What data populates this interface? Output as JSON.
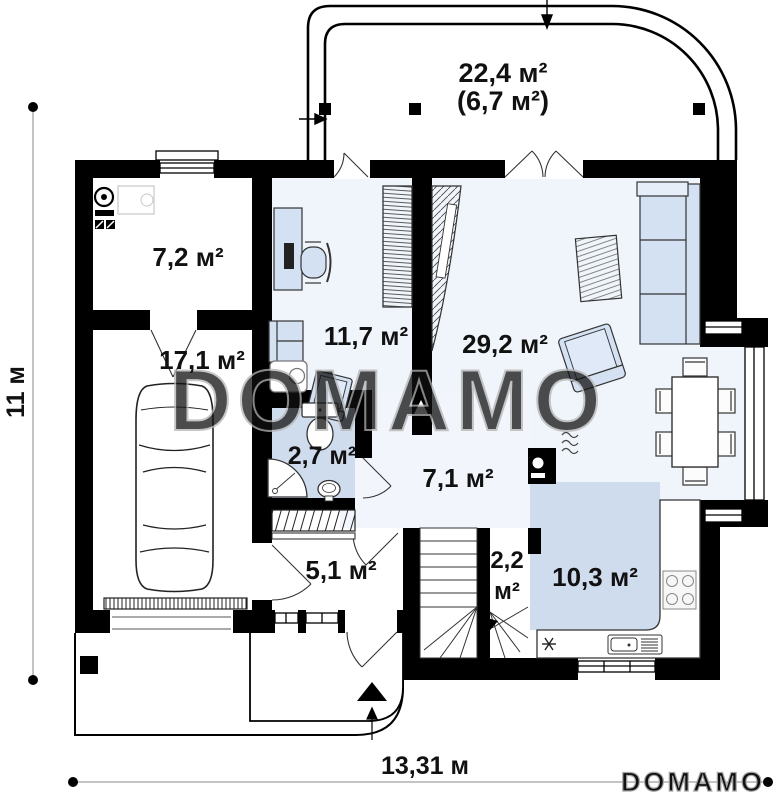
{
  "watermark": {
    "large": "DOMAMO",
    "small": "DOMAMO"
  },
  "dimensions": {
    "width": "13,31 м",
    "height": "11 м"
  },
  "rooms": {
    "terrace": {
      "area": "22,4 м²",
      "area_alt": "(6,7 м²)"
    },
    "boiler_room": {
      "area": "7,2 м²"
    },
    "garage": {
      "area": "17,1 м²"
    },
    "office": {
      "area": "11,7 м²"
    },
    "living_room": {
      "area": "29,2 м²"
    },
    "bathroom": {
      "area": "2,7 м²"
    },
    "hallway": {
      "area": "7,1 м²"
    },
    "entry": {
      "area": "5,1 м²"
    },
    "stairs": {
      "area_value": "2,2",
      "area_unit": "м²"
    },
    "kitchen": {
      "area": "10,3 м²"
    }
  },
  "colors": {
    "wall": "#000000",
    "floor_light": "#f0f5fb",
    "floor_accent": "#cfdcee",
    "furniture": "#d3e1f3",
    "watermark": "#b0b0b0"
  }
}
